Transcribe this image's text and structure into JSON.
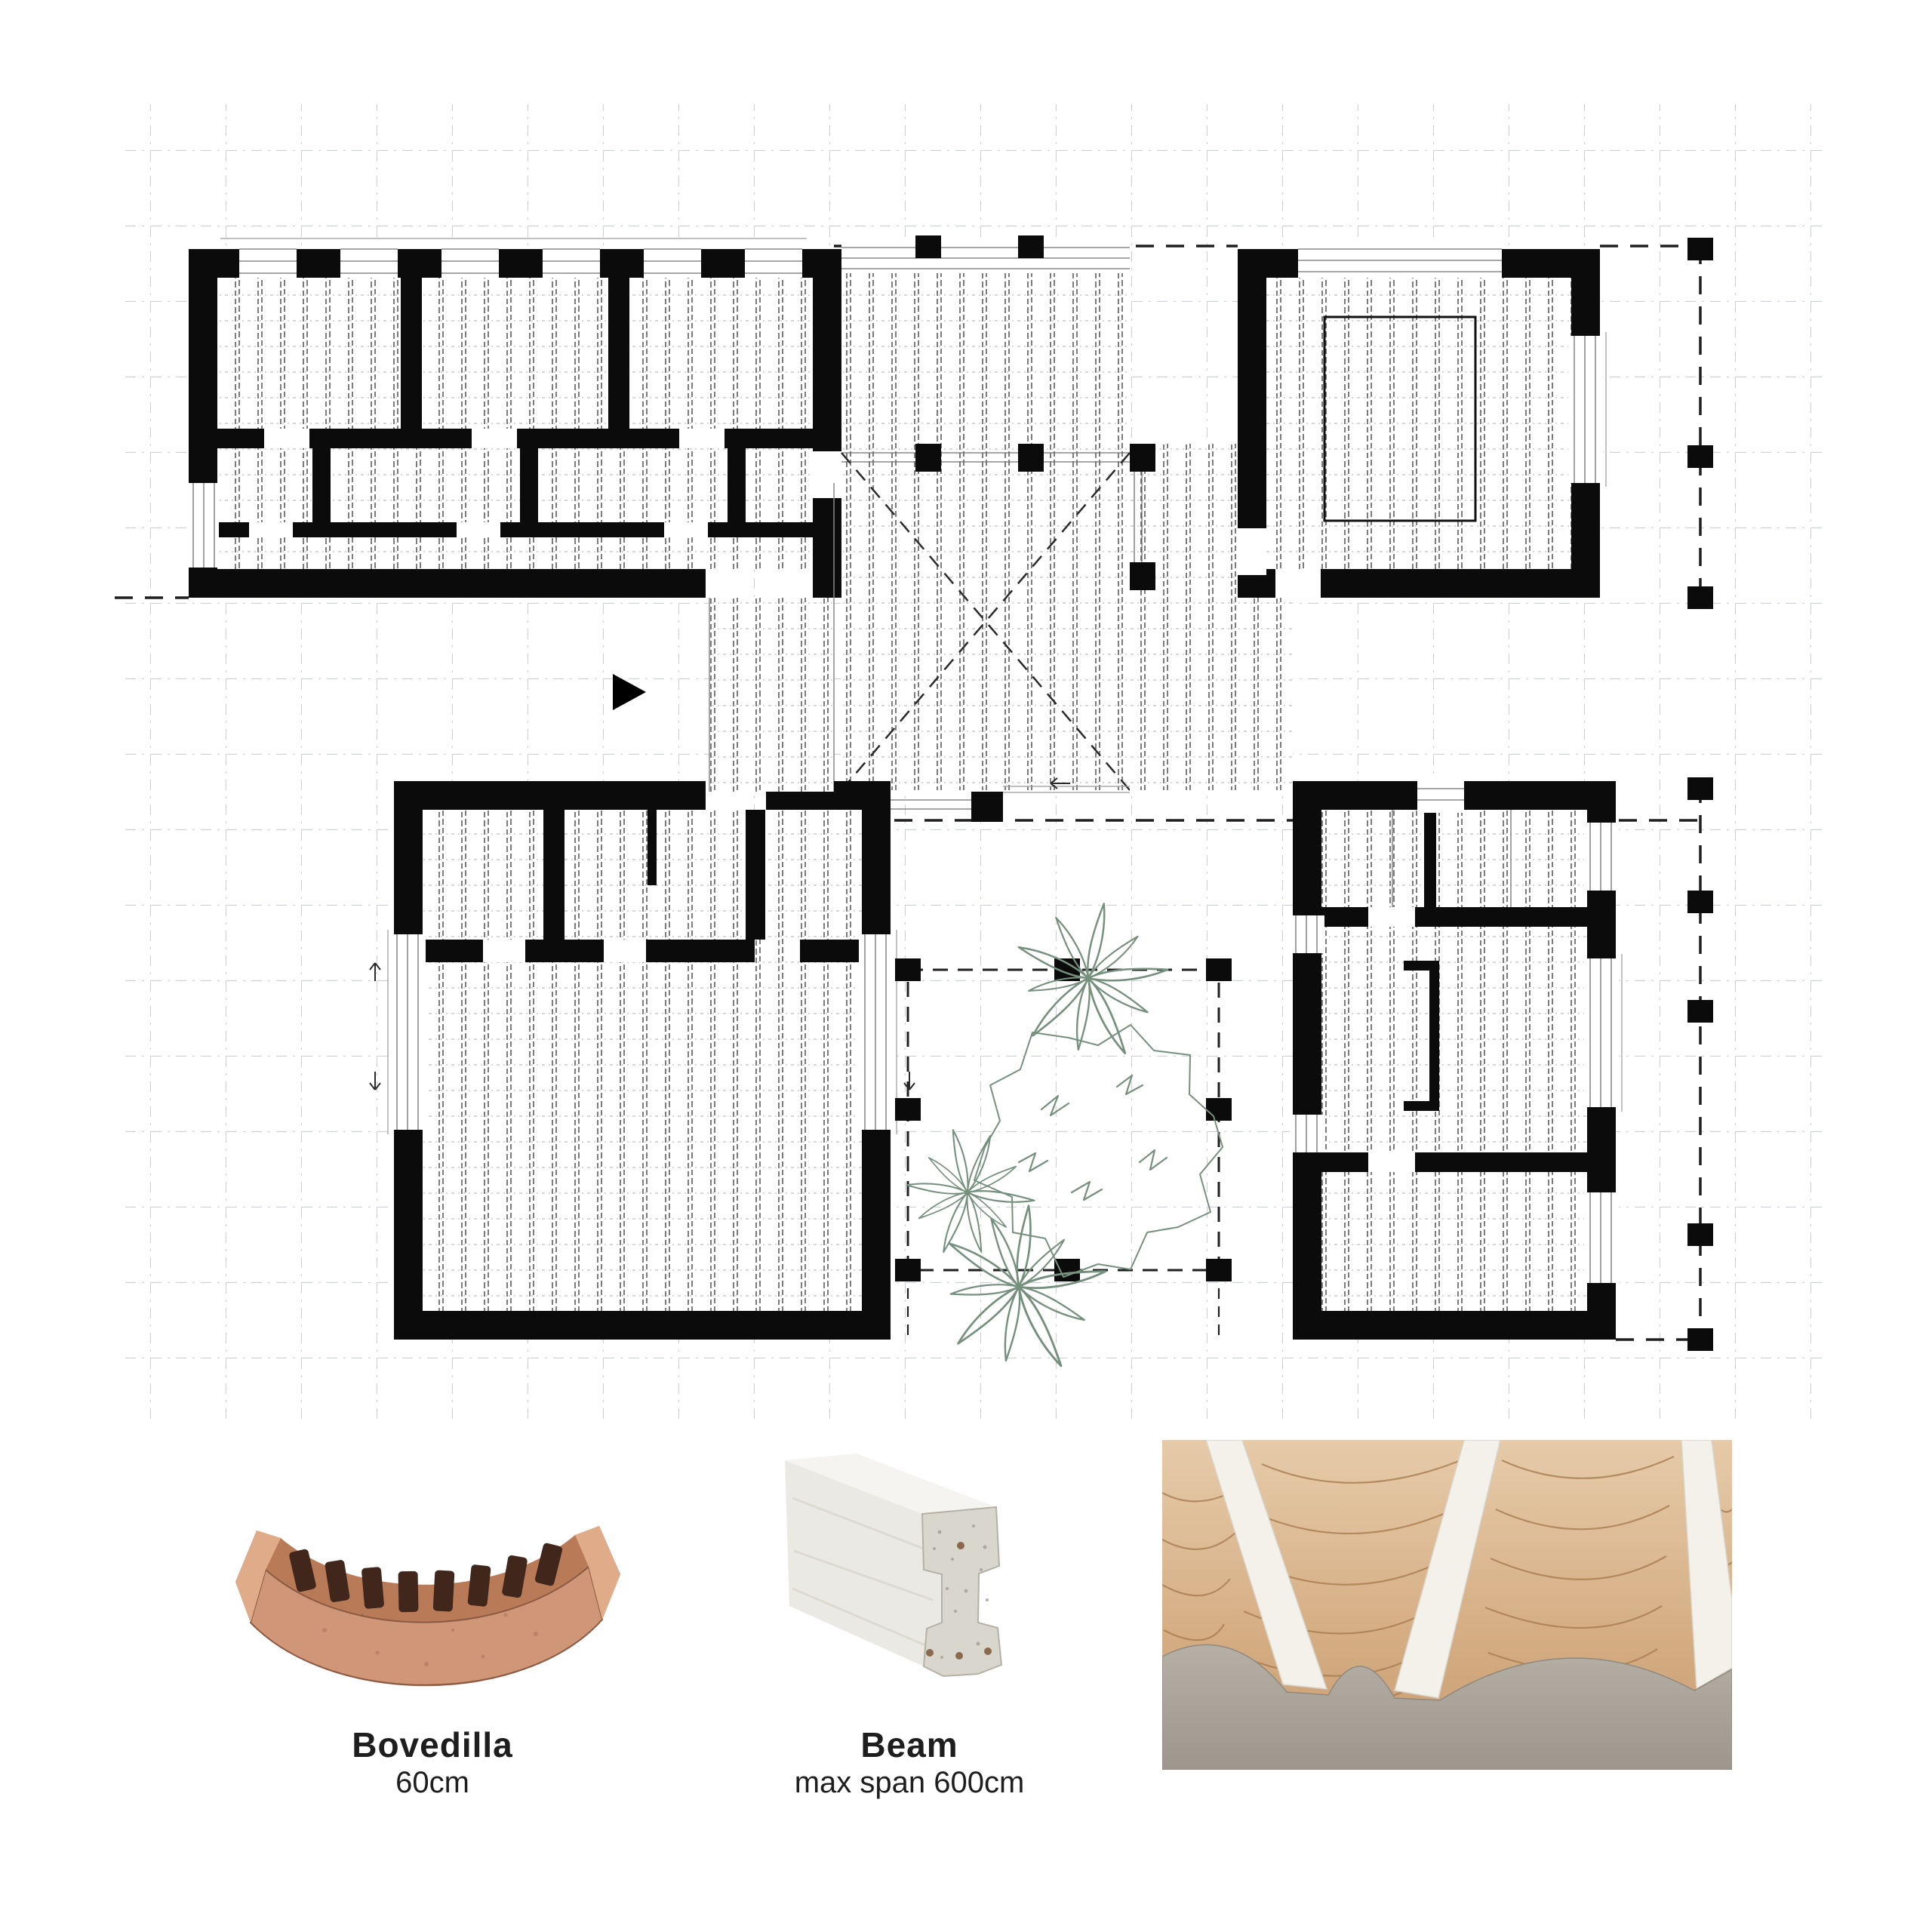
{
  "sheet": {
    "type": "architectural floor plan with construction system legend"
  },
  "legend": {
    "bovedilla": {
      "title": "Bovedilla",
      "subtitle": "60cm"
    },
    "beam": {
      "title": "Beam",
      "subtitle": "max span 600cm"
    }
  },
  "plan": {
    "blocks": [
      {
        "name": "north-west-block"
      },
      {
        "name": "north-east-block"
      },
      {
        "name": "south-west-block"
      },
      {
        "name": "south-east-block"
      },
      {
        "name": "central-hall"
      },
      {
        "name": "courtyard"
      }
    ]
  },
  "colors": {
    "walls": "#0b0b0b",
    "grid": "#cbd0d4",
    "joist_hatch": "#454545",
    "plants": "#76907e",
    "bovedilla_terracotta": "#cd9170",
    "beam_concrete": "#e9e7e1",
    "photo_vault_tan": "#d9b992",
    "photo_wall_grey": "#aaa49a"
  }
}
